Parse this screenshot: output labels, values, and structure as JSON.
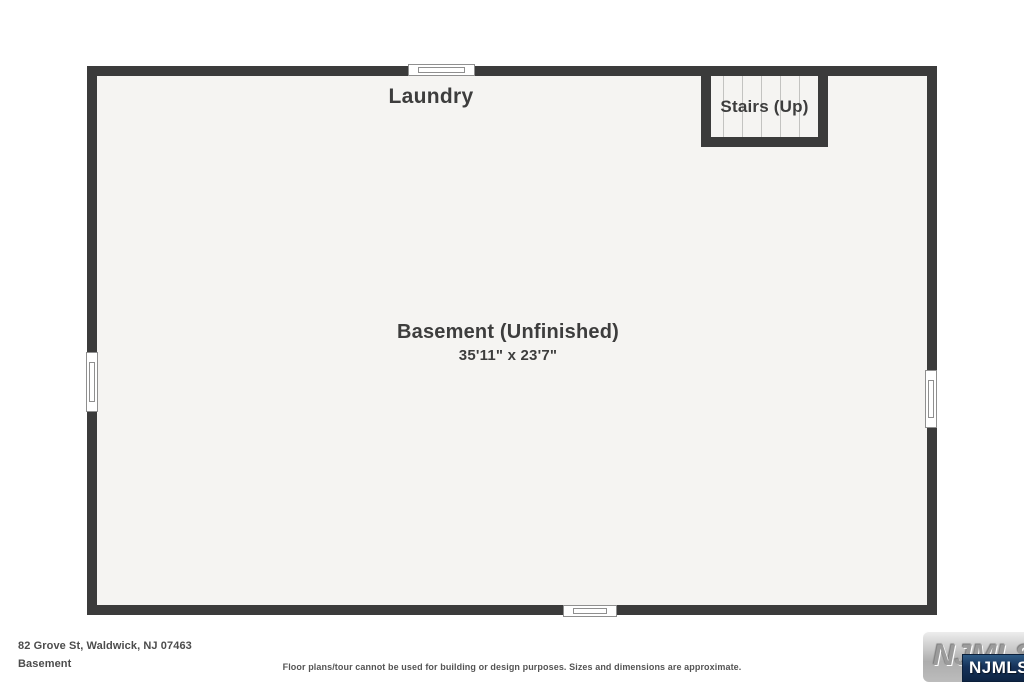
{
  "plan": {
    "laundry_label": "Laundry",
    "stairs_label": "Stairs (Up)",
    "basement_label": "Basement (Unfinished)",
    "basement_dimensions": "35'11\" x 23'7\""
  },
  "footer": {
    "address": "82 Grove St, Waldwick, NJ 07463",
    "floor_label": "Basement",
    "disclaimer": "Floor plans/tour cannot be used for building or design purposes. Sizes and dimensions are approximate."
  },
  "logo": {
    "plate_text": "NJMLS",
    "badge_text": "NJMLS"
  },
  "colors": {
    "wall": "#3b3b3b",
    "floor": "#f5f4f2",
    "label_text": "#3d3d3d",
    "footer_text": "#4c4c4c",
    "window_frame": "#8f8f8f",
    "stair_tread_line": "#c3c3c1",
    "logo_plate_silver": "#c9c9c9",
    "logo_badge_navy": "#16325a"
  }
}
